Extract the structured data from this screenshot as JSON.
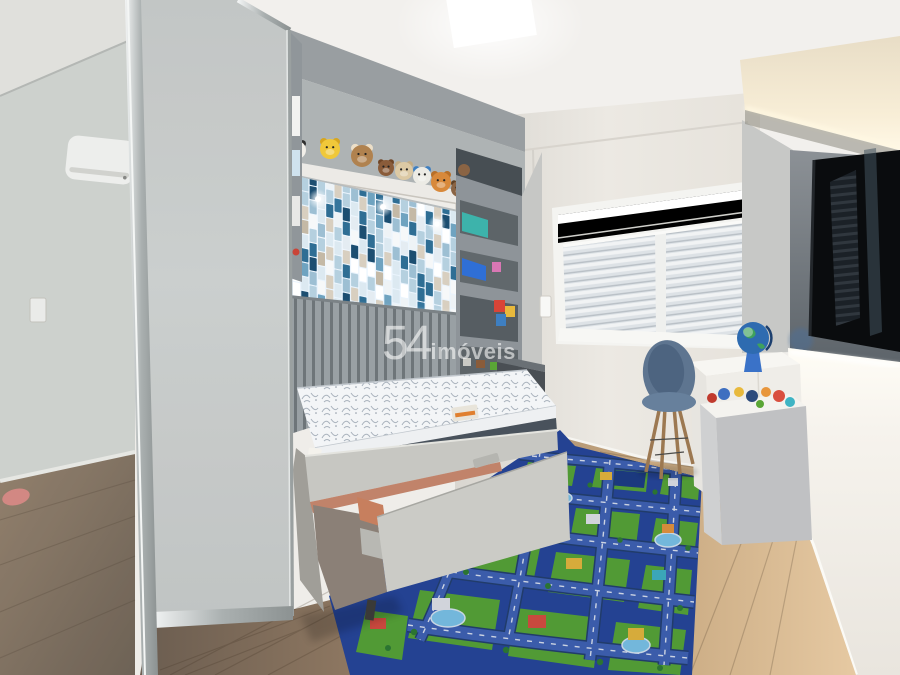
{
  "watermark": {
    "brand_number": "54",
    "brand_name": "imóveis",
    "color": "#ffffff"
  },
  "scene": {
    "room": "children's bedroom real-estate photo",
    "mosaic": {
      "glow": "#eaf4fd",
      "palette": [
        "#f6f8f9",
        "#ffffff",
        "#ffffff",
        "#eef3f6",
        "#dce9f1",
        "#dce9f1",
        "#b5d0df",
        "#b5d0df",
        "#6fa3c0",
        "#2f6e94",
        "#2f6e94",
        "#1c4e71",
        "#1c4e71",
        "#d8cfc0",
        "#d8cfc0",
        "#c4b9a6",
        "#f6f8f9",
        "#e4ecf2",
        "#9dbfd3",
        "#35759c",
        "#ffffff"
      ]
    },
    "plush_toys": [
      {
        "name": "panda",
        "x": 297,
        "y": 150,
        "r": 9,
        "body": "#f2efe9",
        "accent": "#2f2f2f"
      },
      {
        "name": "pikachu",
        "x": 330,
        "y": 149,
        "r": 10,
        "body": "#f0c83a",
        "accent": "#d7a61f"
      },
      {
        "name": "puppy",
        "x": 362,
        "y": 156,
        "r": 11,
        "body": "#b0824f",
        "accent": "#ecdfc8"
      },
      {
        "name": "teddy-small",
        "x": 386,
        "y": 168,
        "r": 8,
        "body": "#8a5c3a",
        "accent": "#6f4526"
      },
      {
        "name": "teddy-cream",
        "x": 404,
        "y": 171,
        "r": 9,
        "body": "#dcc9a4",
        "accent": "#c4ad85"
      },
      {
        "name": "duck",
        "x": 422,
        "y": 176,
        "r": 9,
        "body": "#ecebe5",
        "accent": "#3e7fc1"
      },
      {
        "name": "bear-orange",
        "x": 441,
        "y": 182,
        "r": 10,
        "body": "#d8893b",
        "accent": "#b86f28"
      },
      {
        "name": "monkey",
        "x": 459,
        "y": 189,
        "r": 8,
        "body": "#8a6444",
        "accent": "#5f4227"
      },
      {
        "name": "bear-gray",
        "x": 474,
        "y": 192,
        "r": 8,
        "body": "#b5b0a7",
        "accent": "#979288"
      },
      {
        "name": "teddy-brown",
        "x": 490,
        "y": 197,
        "r": 7,
        "body": "#7c5434",
        "accent": "#5e3d22"
      }
    ],
    "bed": {
      "mattress": "#f3f5f7",
      "mattress_band": "#49525c",
      "base": "#c7c7c2",
      "drawer": "#cbcbc6",
      "accent": "#c1836a"
    },
    "mat": {
      "base": "#26479b",
      "road": "#3f63b5",
      "road_dark": "#23406f",
      "grass": "#57a636",
      "water": "#7cc6ea"
    },
    "tv": {
      "screen": "#0a0c0e"
    },
    "chair": {
      "shell": "#5e7590",
      "legs": "#9c7851"
    },
    "globe": {
      "ocean": "#2e6bb0",
      "land": "#3fa15c",
      "stand": "#3a72c8"
    },
    "wardrobe": {
      "door": "#c3c7c6",
      "frame": "#b9bfbf"
    },
    "floor": {
      "left": "#6b5d50",
      "mid": "#9c8268",
      "right": "#e6c9a2"
    }
  }
}
